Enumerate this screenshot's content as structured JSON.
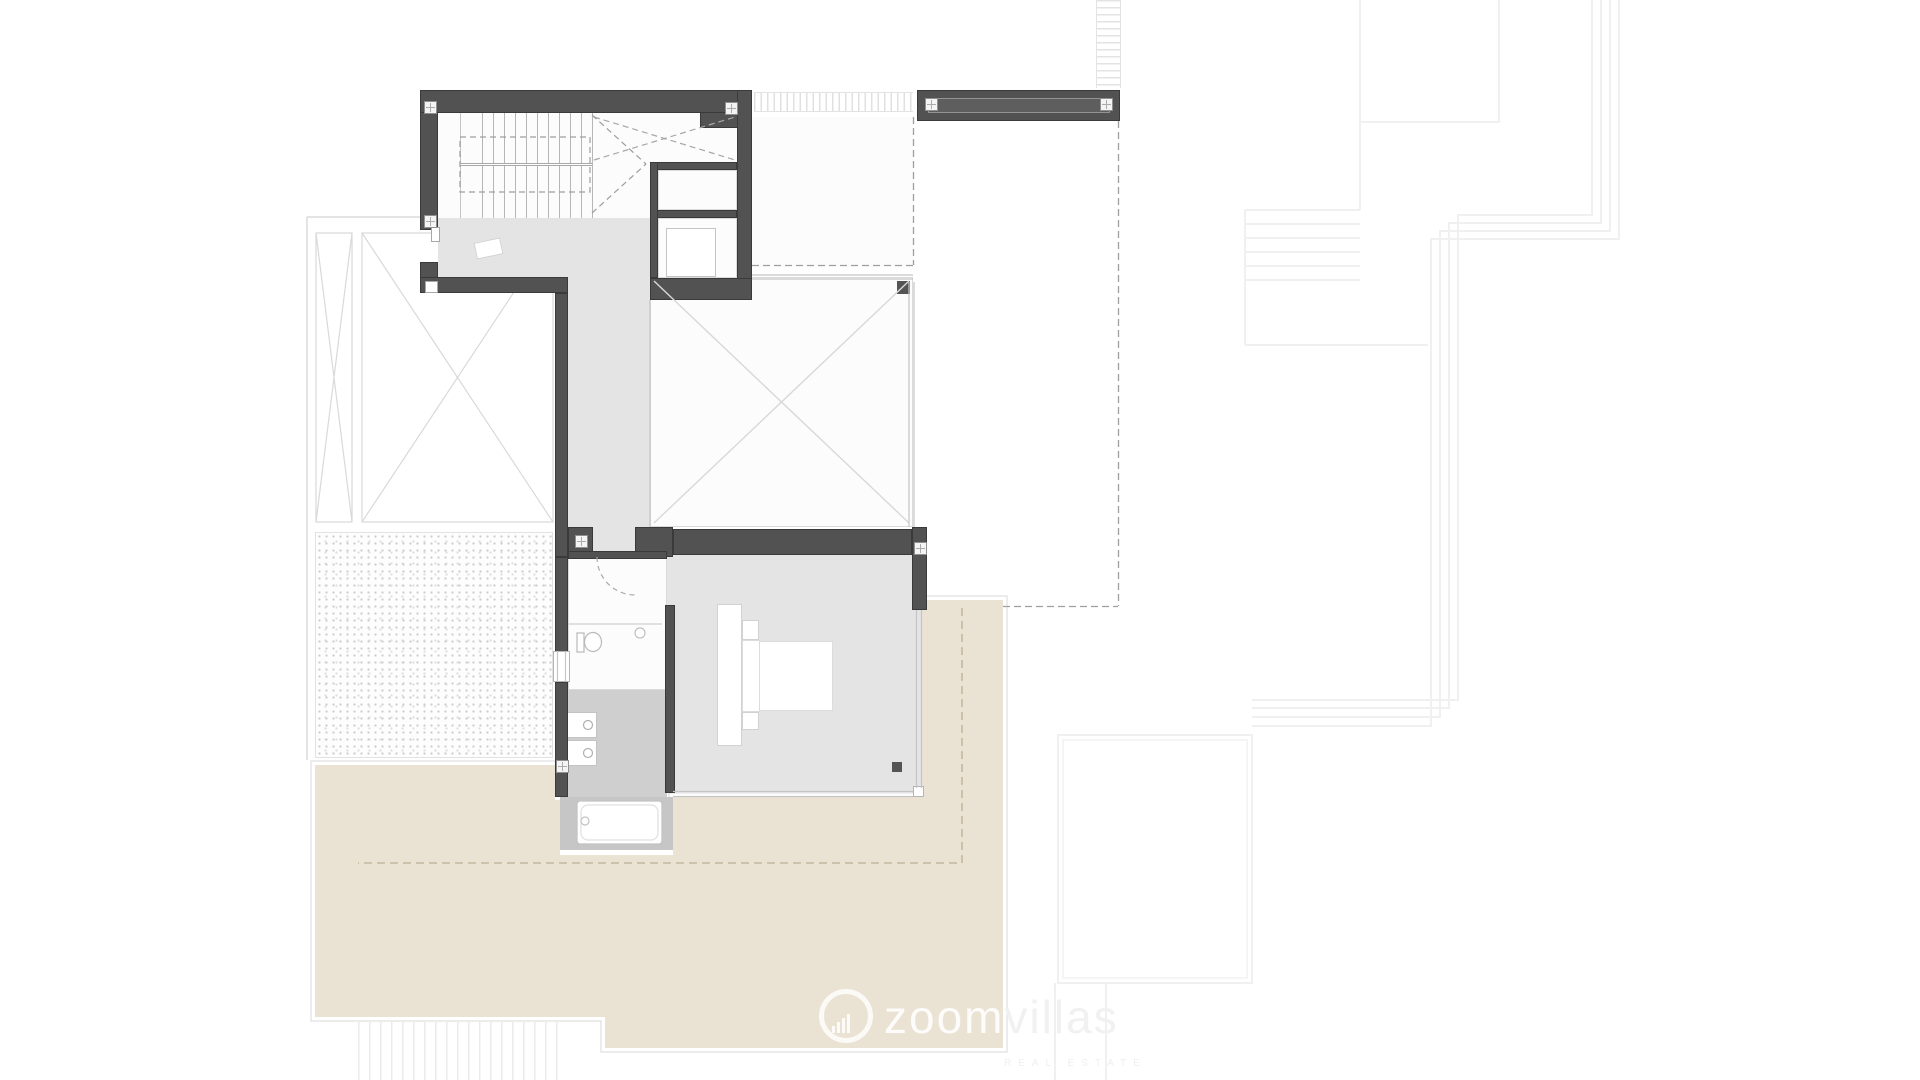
{
  "document": {
    "type": "floor-plan"
  },
  "watermark": {
    "brand_primary": "zoom",
    "brand_secondary": "villas",
    "tagline": "REAL ESTATE",
    "logo_icon": "bar-chart-circle-icon"
  },
  "plan": {
    "stair_tread_count": 10,
    "column_marker_count": 8
  },
  "palette": {
    "wall": "#525252",
    "interior_floor": "#e4e4e5",
    "bathroom_floor": "#cfcfcf",
    "tub_alcove_floor": "#c6c6c6",
    "terrace": "#eae2d3",
    "void_dash_line": "#9f9f9f",
    "terrace_dash_line": "#c4b8a0",
    "background_line": "#f0f0f0"
  }
}
